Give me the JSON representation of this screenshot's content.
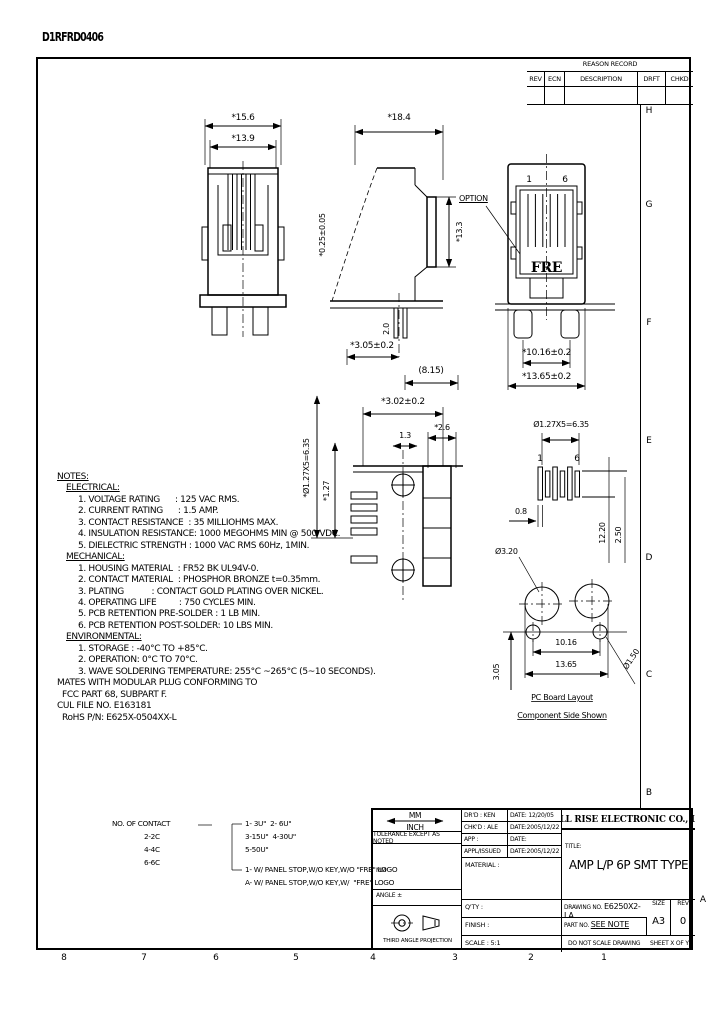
{
  "page": {
    "doc_code": "D1RFRD0406",
    "zone_letters": [
      "H",
      "G",
      "F",
      "E",
      "D",
      "C",
      "B",
      "A"
    ],
    "zone_numbers": [
      "8",
      "7",
      "6",
      "5",
      "4",
      "3",
      "2",
      "1"
    ]
  },
  "revision_table": {
    "title": "REASON RECORD",
    "columns": [
      "REV",
      "ECN",
      "DESCRIPTION",
      "DRFT",
      "CHKD"
    ]
  },
  "views": {
    "front": {
      "dim_outer_width": "*15.6",
      "dim_inner_width": "*13.9"
    },
    "side": {
      "dim_depth": "*18.4",
      "dim_height": "*13.3",
      "dim_contact": "*0.25±0.05",
      "dim_pin": "2.0",
      "dim_standoff": "*3.05±0.2",
      "dim_setback": "(8.15)",
      "option_label": "OPTION"
    },
    "face": {
      "pin_first": "1",
      "pin_last": "6",
      "logo": "FRE",
      "dim_leg_span": "*10.16±0.2",
      "dim_body_width": "*13.65±0.2"
    },
    "smt": {
      "dim_pitch_total": "*Ø1.27X5=6.35",
      "dim_pitch": "*1.27",
      "dim_pad_len": "*3.02±0.2",
      "dim_a": "1.3",
      "dim_b": "*2.6"
    },
    "pads": {
      "dim_pitch_total": "Ø1.27X5=6.35",
      "pin_first": "1",
      "pin_last": "6",
      "dim_pad_width": "0.8",
      "dim_depth": "12.20",
      "dim_depth2": "2.50"
    },
    "pcb": {
      "hole_big": "Ø3.20",
      "hole_small": "Ø1.50",
      "dim_inner": "10.16",
      "dim_outer": "13.65",
      "dim_vert": "3.05",
      "caption_line1": "PC Board Layout",
      "caption_line2": "Component Side Shown"
    }
  },
  "notes": {
    "title": "NOTES:",
    "electrical": {
      "header": "ELECTRICAL:",
      "items": [
        "1. VOLTAGE RATING      : 125 VAC RMS.",
        "2. CURRENT RATING      : 1.5 AMP.",
        "3. CONTACT RESISTANCE  : 35 MILLIOHMS MAX.",
        "4. INSULATION RESISTANCE: 1000 MEGOHMS MIN @ 500 VDC.",
        "5. DIELECTRIC STRENGTH : 1000 VAC RMS 60Hz, 1MIN."
      ]
    },
    "mechanical": {
      "header": "MECHANICAL:",
      "items": [
        "1. HOUSING MATERIAL  : FR52 BK UL94V-0.",
        "2. CONTACT MATERIAL  : PHOSPHOR BRONZE t=0.35mm.",
        "3. PLATING           : CONTACT GOLD PLATING OVER NICKEL.",
        "4. OPERATING LIFE         : 750 CYCLES MIN.",
        "5. PCB RETENTION PRE-SOLDER : 1 LB MIN.",
        "6. PCB RETENTION POST-SOLDER: 10 LBS MIN."
      ]
    },
    "environmental": {
      "header": "ENVIRONMENTAL:",
      "items": [
        "1. STORAGE : -40°C TO +85°C.",
        "2. OPERATION: 0°C TO 70°C.",
        "3. WAVE SOLDERING TEMPERATURE: 255°C ~265°C (5~10 SECONDS)."
      ]
    },
    "footer": [
      "MATES WITH MODULAR PLUG CONFORMING TO",
      "  FCC PART 68, SUBPART F.",
      "CUL FILE NO. E163181",
      "  RoHS P/N: E625X-0504XX-L"
    ]
  },
  "legend": {
    "contacts_header": "NO. OF CONTACT",
    "contacts": [
      "2-2C",
      "4-4C",
      "6-6C"
    ],
    "plating": [
      "1- 3U\"  2- 6U\"",
      "3-15U\"  4-30U\"",
      "5-50U\""
    ],
    "options": [
      "1- W/ PANEL STOP,W/O KEY,W/O \"FRE\" LOGO",
      "A- W/ PANEL STOP,W/O KEY,W/  \"FRE\" LOGO"
    ]
  },
  "title_block": {
    "units_top": "MM",
    "units_bottom": "INCH",
    "tolerance_note": "TOLERANCE EXCEPT AS NOTED",
    "tol_header": "MM",
    "tol_rows": [
      ".X   ±0.38     ±",
      ".XX  ±0.25     ±",
      ".XXX ±0.025    ±"
    ],
    "angle": "ANGLE ±",
    "projection": "THIRD ANGLE PROJECTION",
    "staff": [
      {
        "label": "DR'D : KEN",
        "date": "DATE: 12/20/05"
      },
      {
        "label": "CHK'D : ALE",
        "date": "DATE:2005/12/22"
      },
      {
        "label": "APP :",
        "date": "DATE:"
      },
      {
        "label": "APPL/ISSUED",
        "date": "DATE:2005/12/22"
      }
    ],
    "material_label": "MATERIAL :",
    "qty_label": "Q'TY :",
    "finish_label": "FINISH :",
    "scale_label": "SCALE : 5:1",
    "company": "FULL RISE ELECTRONIC CO., LTD",
    "title_label": "TITLE:",
    "title": "AMP L/P 6P SMT TYPE",
    "drawing_no_label": "DRAWING NO.",
    "drawing_no": "E6250X2-LA",
    "part_no_label": "PART NO.",
    "part_no": "SEE NOTE",
    "size_label": "SIZE",
    "size": "A3",
    "rev_label": "REV",
    "rev": "0",
    "do_not_scale": "DO NOT SCALE DRAWING",
    "sheet": "SHEET X OF Y"
  }
}
